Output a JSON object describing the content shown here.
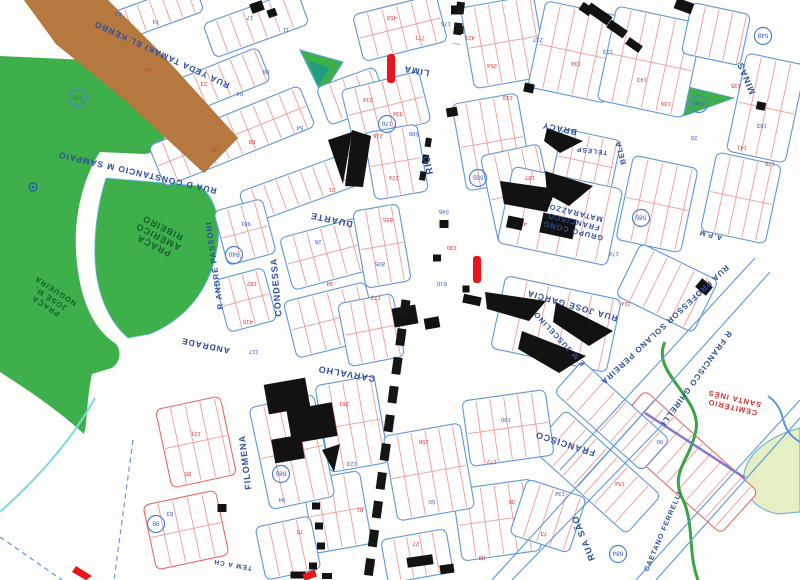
{
  "map": {
    "title": "cadastral city map scan (rotated 180°)",
    "colors": {
      "park_green": "#3db04b",
      "park_text": "#175c2a",
      "brown": "#b5793f",
      "block_stroke": "#5f97d6",
      "pink_block_stroke": "#e86a6a",
      "lot_line": "#f09b9b",
      "label_blue": "#2d4f9b",
      "number_red": "#cc3b3b",
      "number_blue": "#3b5fc0",
      "building_black": "#121212",
      "red_mark": "#e8141e",
      "teal": "#1f9e84",
      "stream_green": "#3aa344",
      "stream_cyan": "#7fd9d9",
      "purple": "#8673cc",
      "pale_blob": "#e4efc4"
    },
    "street_labels": [
      {
        "id": "tamaki",
        "text": "RUA YEDA TAMAKI EL KERBO",
        "x": 163,
        "y": 52,
        "rot": 205,
        "size": 8.5
      },
      {
        "id": "sampaio",
        "text": "RUA D CONSTANCIO M SAMPAIO",
        "x": 138,
        "y": 170,
        "rot": 193,
        "size": 8.5
      },
      {
        "id": "passoni",
        "text": "R ANDRÉ PASSONI",
        "x": 217,
        "y": 265,
        "rot": 262,
        "size": 8
      },
      {
        "id": "andrade",
        "text": "ANDRADE",
        "x": 206,
        "y": 343,
        "rot": 192,
        "size": 8.5
      },
      {
        "id": "duarte",
        "text": "DUARTE",
        "x": 332,
        "y": 217,
        "rot": 192,
        "size": 9
      },
      {
        "id": "condessa",
        "text": "CONDESSA",
        "x": 279,
        "y": 287,
        "rot": 265,
        "size": 9
      },
      {
        "id": "carvalho",
        "text": "CARVALHO",
        "x": 347,
        "y": 371,
        "rot": 190,
        "size": 9
      },
      {
        "id": "rio",
        "text": "RIO",
        "x": 431,
        "y": 164,
        "rot": 258,
        "size": 9.5
      },
      {
        "id": "lima",
        "text": "LIMA",
        "x": 417,
        "y": 68,
        "rot": 190,
        "size": 9
      },
      {
        "id": "filomena",
        "text": "FILOMENA",
        "x": 248,
        "y": 462,
        "rot": 263,
        "size": 9
      },
      {
        "id": "rua-sao",
        "text": "RUA SÃO",
        "x": 586,
        "y": 537,
        "rot": 248,
        "size": 9
      },
      {
        "id": "francisco",
        "text": "FRANCISCO",
        "x": 566,
        "y": 441,
        "rot": 198,
        "size": 9
      },
      {
        "id": "jose-garcia",
        "text": "RUA JOSÉ GARCIA",
        "x": 573,
        "y": 303,
        "rot": 196,
        "size": 8.5
      },
      {
        "id": "solano",
        "text": "RUA PROFESSOR SOLANO PEREIRA",
        "x": 663,
        "y": 323,
        "rot": 137,
        "size": 8
      },
      {
        "id": "ghirelli",
        "text": "R FRANCISCO GHIRELLI",
        "x": 694,
        "y": 377,
        "rot": 126,
        "size": 8
      },
      {
        "id": "minas",
        "text": "MINAS",
        "x": 749,
        "y": 77,
        "rot": 247,
        "size": 9
      },
      {
        "id": "bracy",
        "text": "BRACY",
        "x": 560,
        "y": 126,
        "rot": 192,
        "size": 8.5
      },
      {
        "id": "bela",
        "text": "BELA",
        "x": 623,
        "y": 152,
        "rot": 255,
        "size": 7.5
      },
      {
        "id": "telesp",
        "text": "TELESP",
        "x": 592,
        "y": 149,
        "rot": 187,
        "size": 6.5
      },
      {
        "id": "juscelino",
        "text": "E M JUSCELINO",
        "x": 561,
        "y": 337,
        "rot": 227,
        "size": 7.5
      },
      {
        "id": "apm",
        "text": "A.P.M",
        "x": 711,
        "y": 233,
        "rot": 195,
        "size": 7
      },
      {
        "id": "tem-a-ch",
        "text": "TEM A CH",
        "x": 233,
        "y": 563,
        "rot": 190,
        "size": 6.5
      },
      {
        "id": "caetano",
        "text": "CAETANO FERRELLI",
        "x": 665,
        "y": 532,
        "rot": 293,
        "size": 7
      }
    ],
    "area_labels": [
      {
        "id": "praca-americo",
        "lines": [
          "PRAÇA",
          "AMÉRICO",
          "RIBEIRO"
        ],
        "x": 155,
        "y": 243,
        "rot": 207,
        "size": 9,
        "lh": 10,
        "color": "#175c2a"
      },
      {
        "id": "praca-nogueira",
        "lines": [
          "PRAÇA",
          "JOSÉ M.",
          "NOGUEIRA"
        ],
        "x": 47,
        "y": 304,
        "rot": 213,
        "size": 7.5,
        "lh": 9,
        "color": "#175c2a"
      },
      {
        "id": "matarazzo",
        "lines": [
          "GRUPO CONG.",
          "FRANCISCO",
          "MATARAZZO"
        ],
        "x": 572,
        "y": 228,
        "rot": 194,
        "size": 7.5,
        "lh": 9,
        "color": "#2d4f9b"
      },
      {
        "id": "cemiterio",
        "lines": [
          "CEMITÉRIO",
          "SANTA INÊS"
        ],
        "x": 733,
        "y": 405,
        "rot": 193,
        "size": 7.5,
        "lh": 9,
        "color": "#cc3333"
      }
    ],
    "block_ids": [
      {
        "n": "775",
        "x": 78,
        "y": 98
      },
      {
        "n": "940",
        "x": 234,
        "y": 255
      },
      {
        "n": "176",
        "x": 387,
        "y": 124
      },
      {
        "n": "565",
        "x": 478,
        "y": 178
      },
      {
        "n": "585",
        "x": 641,
        "y": 218
      },
      {
        "n": "196",
        "x": 699,
        "y": 104
      },
      {
        "n": "685",
        "x": 281,
        "y": 474
      },
      {
        "n": "684",
        "x": 618,
        "y": 554
      },
      {
        "n": "98",
        "x": 156,
        "y": 524
      },
      {
        "n": "548",
        "x": 763,
        "y": 36
      }
    ],
    "lot_numbers": [
      {
        "n": "54",
        "x": 118,
        "y": 12,
        "c": "b"
      },
      {
        "n": "74",
        "x": 156,
        "y": 20,
        "c": "b"
      },
      {
        "n": "17",
        "x": 250,
        "y": 16,
        "c": "b"
      },
      {
        "n": "11",
        "x": 286,
        "y": 28,
        "c": "b"
      },
      {
        "n": "69",
        "x": 148,
        "y": 68,
        "c": "r"
      },
      {
        "n": "23",
        "x": 204,
        "y": 82,
        "c": "r"
      },
      {
        "n": "04",
        "x": 240,
        "y": 92,
        "c": "b"
      },
      {
        "n": "08",
        "x": 266,
        "y": 70,
        "c": "b"
      },
      {
        "n": "54",
        "x": 300,
        "y": 126,
        "c": "b"
      },
      {
        "n": "88",
        "x": 252,
        "y": 140,
        "c": "r"
      },
      {
        "n": "47",
        "x": 214,
        "y": 148,
        "c": "r"
      },
      {
        "n": "21",
        "x": 332,
        "y": 188,
        "c": "r"
      },
      {
        "n": "453",
        "x": 392,
        "y": 16,
        "c": "r"
      },
      {
        "n": "771",
        "x": 420,
        "y": 36,
        "c": "r"
      },
      {
        "n": "175",
        "x": 446,
        "y": 22,
        "c": "b"
      },
      {
        "n": "214",
        "x": 368,
        "y": 98,
        "c": "r"
      },
      {
        "n": "334",
        "x": 398,
        "y": 112,
        "c": "r"
      },
      {
        "n": "586",
        "x": 414,
        "y": 132,
        "c": "b"
      },
      {
        "n": "216",
        "x": 378,
        "y": 134,
        "c": "r"
      },
      {
        "n": "423",
        "x": 470,
        "y": 36,
        "c": "r"
      },
      {
        "n": "254",
        "x": 492,
        "y": 64,
        "c": "r"
      },
      {
        "n": "133",
        "x": 508,
        "y": 96,
        "c": "r"
      },
      {
        "n": "217",
        "x": 538,
        "y": 38,
        "c": "b"
      },
      {
        "n": "134",
        "x": 576,
        "y": 62,
        "c": "r"
      },
      {
        "n": "123",
        "x": 608,
        "y": 50,
        "c": "b"
      },
      {
        "n": "143",
        "x": 642,
        "y": 78,
        "c": "r"
      },
      {
        "n": "139",
        "x": 666,
        "y": 102,
        "c": "r"
      },
      {
        "n": "135",
        "x": 736,
        "y": 84,
        "c": "r"
      },
      {
        "n": "163",
        "x": 762,
        "y": 124,
        "c": "b"
      },
      {
        "n": "178",
        "x": 770,
        "y": 162,
        "c": "r"
      },
      {
        "n": "20",
        "x": 694,
        "y": 136,
        "c": "b"
      },
      {
        "n": "141",
        "x": 742,
        "y": 146,
        "c": "r"
      },
      {
        "n": "981",
        "x": 246,
        "y": 222,
        "c": "b"
      },
      {
        "n": "182",
        "x": 252,
        "y": 282,
        "c": "r"
      },
      {
        "n": "415",
        "x": 248,
        "y": 320,
        "c": "r"
      },
      {
        "n": "117",
        "x": 254,
        "y": 350,
        "c": "b"
      },
      {
        "n": "26",
        "x": 318,
        "y": 240,
        "c": "b"
      },
      {
        "n": "34",
        "x": 330,
        "y": 282,
        "c": "r"
      },
      {
        "n": "224",
        "x": 394,
        "y": 176,
        "c": "r"
      },
      {
        "n": "655",
        "x": 388,
        "y": 218,
        "c": "r"
      },
      {
        "n": "805",
        "x": 380,
        "y": 262,
        "c": "b"
      },
      {
        "n": "173",
        "x": 376,
        "y": 296,
        "c": "r"
      },
      {
        "n": "546",
        "x": 444,
        "y": 210,
        "c": "b"
      },
      {
        "n": "190",
        "x": 452,
        "y": 246,
        "c": "r"
      },
      {
        "n": "610",
        "x": 442,
        "y": 282,
        "c": "b"
      },
      {
        "n": "453",
        "x": 522,
        "y": 222,
        "c": "r"
      },
      {
        "n": "187",
        "x": 530,
        "y": 176,
        "c": "r"
      },
      {
        "n": "174",
        "x": 614,
        "y": 252,
        "c": "b"
      },
      {
        "n": "114",
        "x": 626,
        "y": 302,
        "c": "r"
      },
      {
        "n": "261",
        "x": 344,
        "y": 402,
        "c": "r"
      },
      {
        "n": "138",
        "x": 300,
        "y": 422,
        "c": "r"
      },
      {
        "n": "94",
        "x": 282,
        "y": 498,
        "c": "b"
      },
      {
        "n": "70",
        "x": 300,
        "y": 530,
        "c": "r"
      },
      {
        "n": "123",
        "x": 352,
        "y": 462,
        "c": "b"
      },
      {
        "n": "81",
        "x": 360,
        "y": 508,
        "c": "r"
      },
      {
        "n": "156",
        "x": 424,
        "y": 440,
        "c": "r"
      },
      {
        "n": "50",
        "x": 432,
        "y": 500,
        "c": "b"
      },
      {
        "n": "27",
        "x": 416,
        "y": 542,
        "c": "r"
      },
      {
        "n": "190",
        "x": 506,
        "y": 418,
        "c": "b"
      },
      {
        "n": "172",
        "x": 492,
        "y": 460,
        "c": "r"
      },
      {
        "n": "30",
        "x": 512,
        "y": 500,
        "c": "r"
      },
      {
        "n": "134",
        "x": 560,
        "y": 492,
        "c": "b"
      },
      {
        "n": "73",
        "x": 544,
        "y": 532,
        "c": "r"
      },
      {
        "n": "154",
        "x": 620,
        "y": 482,
        "c": "r"
      },
      {
        "n": "90",
        "x": 660,
        "y": 440,
        "c": "b"
      },
      {
        "n": "121",
        "x": 196,
        "y": 432,
        "c": "r"
      },
      {
        "n": "85",
        "x": 188,
        "y": 472,
        "c": "r"
      },
      {
        "n": "63",
        "x": 170,
        "y": 512,
        "c": "b"
      },
      {
        "n": "98",
        "x": 372,
        "y": 562,
        "c": "r"
      },
      {
        "n": "88",
        "x": 482,
        "y": 556,
        "c": "r"
      }
    ]
  }
}
